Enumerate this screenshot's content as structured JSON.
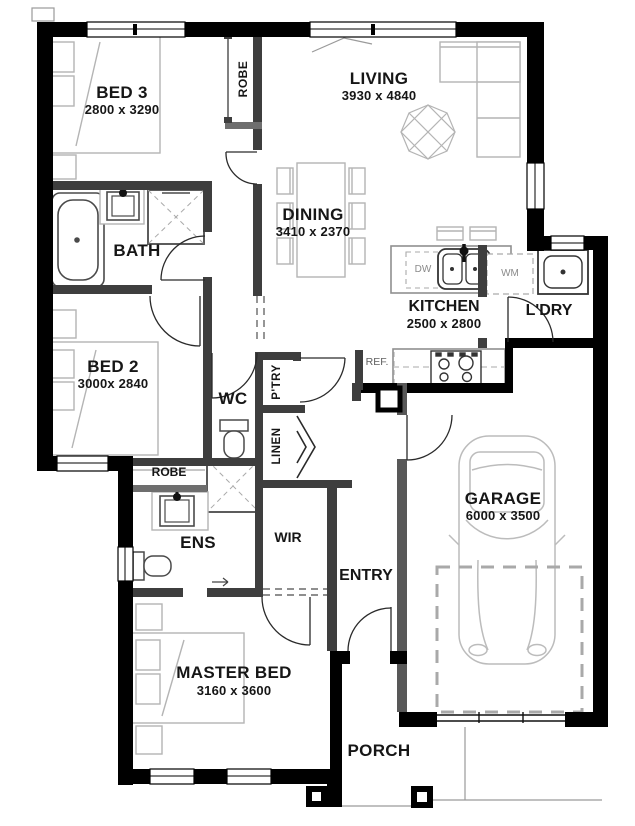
{
  "meta": {
    "type": "residential floor plan"
  },
  "rooms": {
    "bed3": {
      "name": "BED 3",
      "dims": "2800 x 3290"
    },
    "living": {
      "name": "LIVING",
      "dims": "3930 x 4840"
    },
    "dining": {
      "name": "DINING",
      "dims": "3410 x 2370"
    },
    "bath": {
      "name": "BATH"
    },
    "kitchen": {
      "name": "KITCHEN",
      "dims": "2500 x 2800"
    },
    "laundry": {
      "name": "L'DRY"
    },
    "bed2": {
      "name": "BED 2",
      "dims": "3000x 2840"
    },
    "wc": {
      "name": "WC"
    },
    "pantry": {
      "name": "P'TRY"
    },
    "linen": {
      "name": "LINEN"
    },
    "robe_bed3": {
      "name": "ROBE"
    },
    "robe_ens": {
      "name": "ROBE"
    },
    "ens": {
      "name": "ENS"
    },
    "wir": {
      "name": "WIR"
    },
    "entry": {
      "name": "ENTRY"
    },
    "garage": {
      "name": "GARAGE",
      "dims": "6000 x 3500"
    },
    "master": {
      "name": "MASTER BED",
      "dims": "3160 x 3600"
    },
    "porch": {
      "name": "PORCH"
    }
  },
  "appliances": {
    "dishwasher": "DW",
    "washing_machine": "WM",
    "fridge": "REF."
  },
  "colors": {
    "exterior_wall": "#000000",
    "interior_wall": "#3e3e3e",
    "furniture_line": "#b4b4b4",
    "fixture_line": "#4a4a4a",
    "label_text": "#161616",
    "background": "#ffffff"
  }
}
